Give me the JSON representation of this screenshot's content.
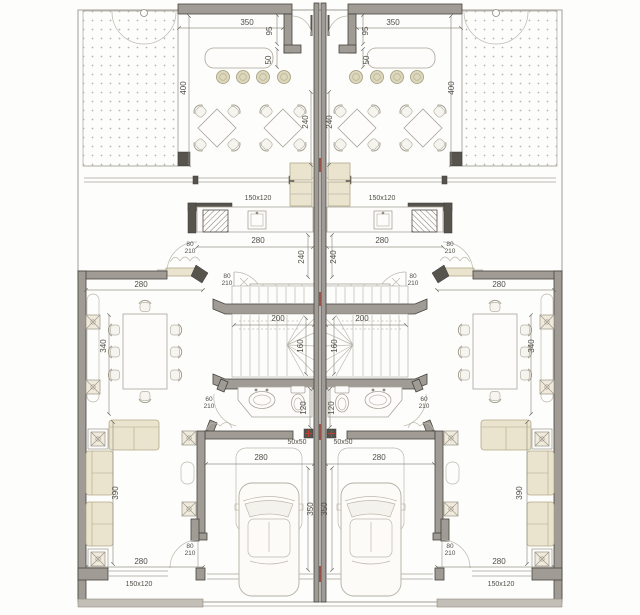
{
  "plan": {
    "kind": "architectural-floor-plan",
    "units_count": 2,
    "mirrored": true,
    "legend": [
      "garden-gravel",
      "gate-swing",
      "bar-counter",
      "bar-stool",
      "terrace-table",
      "terrace-chair",
      "kitchen-counter",
      "stove",
      "kitchen-sink",
      "fridge",
      "closet",
      "stair",
      "bathroom-vanity",
      "wash-basin",
      "toilet",
      "column",
      "garage",
      "car",
      "dining-table",
      "dining-chair",
      "sofa",
      "side-table",
      "planter",
      "door-swing",
      "window",
      "party-wall",
      "property-boundary"
    ]
  },
  "colors": {
    "paper": "#fdfdfb",
    "wall_fill": "#a09c95",
    "wall_edge": "#45433f",
    "dark_block": "#57544e",
    "furniture_beige": "#eae3cd",
    "beige_stroke": "#b2a989",
    "line": "#a6a299",
    "dim_text": "#514e46",
    "red_accent": "#c23b2e"
  },
  "labels": [
    {
      "name": "dim-terrace-width-left",
      "text": "350",
      "x": 247,
      "y": 25
    },
    {
      "name": "dim-vestibule-depth-left",
      "text": "95",
      "x": 272,
      "y": 31,
      "rot": -90
    },
    {
      "name": "dim-counter-depth-left",
      "text": "50",
      "x": 271,
      "y": 60,
      "rot": -90
    },
    {
      "name": "dim-terrace-depth-left",
      "text": "400",
      "x": 186,
      "y": 88,
      "rot": -90
    },
    {
      "name": "dim-terrace-seating-left",
      "text": "240",
      "x": 308,
      "y": 122,
      "rot": -90
    },
    {
      "name": "window-kitchen-left",
      "text": "150x120",
      "x": 258,
      "y": 200,
      "cls": "small"
    },
    {
      "name": "dim-kitchen-width-left",
      "text": "280",
      "x": 258,
      "y": 243
    },
    {
      "name": "door-kitchen-left",
      "lines": [
        "80",
        "210"
      ],
      "x": 190,
      "y": 246,
      "cls": "stack"
    },
    {
      "name": "dim-corridor-left",
      "text": "240",
      "x": 304,
      "y": 257,
      "rot": -90
    },
    {
      "name": "door-hall-left",
      "lines": [
        "80",
        "210"
      ],
      "x": 227,
      "y": 278,
      "cls": "stack"
    },
    {
      "name": "dim-dining-width-left",
      "text": "280",
      "x": 141,
      "y": 287
    },
    {
      "name": "dim-stair-width-left",
      "text": "200",
      "x": 278,
      "y": 321
    },
    {
      "name": "dim-dining-depth-left",
      "text": "340",
      "x": 106,
      "y": 346,
      "rot": -90
    },
    {
      "name": "dim-stair-depth-left",
      "text": "160",
      "x": 303,
      "y": 346,
      "rot": -90
    },
    {
      "name": "door-bath-left",
      "lines": [
        "60",
        "210"
      ],
      "x": 209,
      "y": 401,
      "cls": "stack"
    },
    {
      "name": "dim-toilet-left",
      "text": "120",
      "x": 306,
      "y": 408,
      "rot": -90
    },
    {
      "name": "column-size-left",
      "text": "50x50",
      "x": 297,
      "y": 444,
      "cls": "small"
    },
    {
      "name": "dim-garage-width-left",
      "text": "280",
      "x": 261,
      "y": 460
    },
    {
      "name": "dim-living-depth-left",
      "text": "390",
      "x": 118,
      "y": 493,
      "rot": -90
    },
    {
      "name": "dim-garage-depth-left",
      "text": "350",
      "x": 313,
      "y": 509,
      "rot": -90
    },
    {
      "name": "door-rear-left",
      "lines": [
        "80",
        "210"
      ],
      "x": 190,
      "y": 548,
      "cls": "stack"
    },
    {
      "name": "dim-living-width-left",
      "text": "280",
      "x": 141,
      "y": 564
    },
    {
      "name": "window-rear-left",
      "text": "150x120",
      "x": 139,
      "y": 586,
      "cls": "small"
    },
    {
      "name": "dim-terrace-width-right",
      "text": "350",
      "x": 393,
      "y": 25
    },
    {
      "name": "dim-vestibule-depth-right",
      "text": "95",
      "x": 368,
      "y": 31,
      "rot": -90
    },
    {
      "name": "dim-counter-depth-right",
      "text": "50",
      "x": 369,
      "y": 60,
      "rot": -90
    },
    {
      "name": "dim-terrace-depth-right",
      "text": "400",
      "x": 454,
      "y": 88,
      "rot": -90
    },
    {
      "name": "dim-terrace-seating-right",
      "text": "240",
      "x": 332,
      "y": 122,
      "rot": -90
    },
    {
      "name": "window-kitchen-right",
      "text": "150x120",
      "x": 382,
      "y": 200,
      "cls": "small"
    },
    {
      "name": "dim-kitchen-width-right",
      "text": "280",
      "x": 382,
      "y": 243
    },
    {
      "name": "door-kitchen-right",
      "lines": [
        "80",
        "210"
      ],
      "x": 450,
      "y": 246,
      "cls": "stack"
    },
    {
      "name": "dim-corridor-right",
      "text": "240",
      "x": 336,
      "y": 257,
      "rot": -90
    },
    {
      "name": "door-hall-right",
      "lines": [
        "80",
        "210"
      ],
      "x": 413,
      "y": 278,
      "cls": "stack"
    },
    {
      "name": "dim-dining-width-right",
      "text": "280",
      "x": 499,
      "y": 287
    },
    {
      "name": "dim-stair-width-right",
      "text": "200",
      "x": 362,
      "y": 321
    },
    {
      "name": "dim-dining-depth-right",
      "text": "340",
      "x": 534,
      "y": 346,
      "rot": -90
    },
    {
      "name": "dim-stair-depth-right",
      "text": "160",
      "x": 337,
      "y": 346,
      "rot": -90
    },
    {
      "name": "door-bath-right",
      "lines": [
        "60",
        "210"
      ],
      "x": 424,
      "y": 401,
      "cls": "stack"
    },
    {
      "name": "dim-toilet-right",
      "text": "120",
      "x": 334,
      "y": 408,
      "rot": -90
    },
    {
      "name": "column-size-right",
      "text": "50x50",
      "x": 343,
      "y": 444,
      "cls": "small"
    },
    {
      "name": "dim-garage-width-right",
      "text": "280",
      "x": 379,
      "y": 460
    },
    {
      "name": "dim-living-depth-right",
      "text": "390",
      "x": 522,
      "y": 493,
      "rot": -90
    },
    {
      "name": "dim-garage-depth-right",
      "text": "350",
      "x": 327,
      "y": 509,
      "rot": -90
    },
    {
      "name": "door-rear-right",
      "lines": [
        "80",
        "210"
      ],
      "x": 450,
      "y": 548,
      "cls": "stack"
    },
    {
      "name": "dim-living-width-right",
      "text": "280",
      "x": 499,
      "y": 564
    },
    {
      "name": "window-rear-right",
      "text": "150x120",
      "x": 501,
      "y": 586,
      "cls": "small"
    }
  ]
}
